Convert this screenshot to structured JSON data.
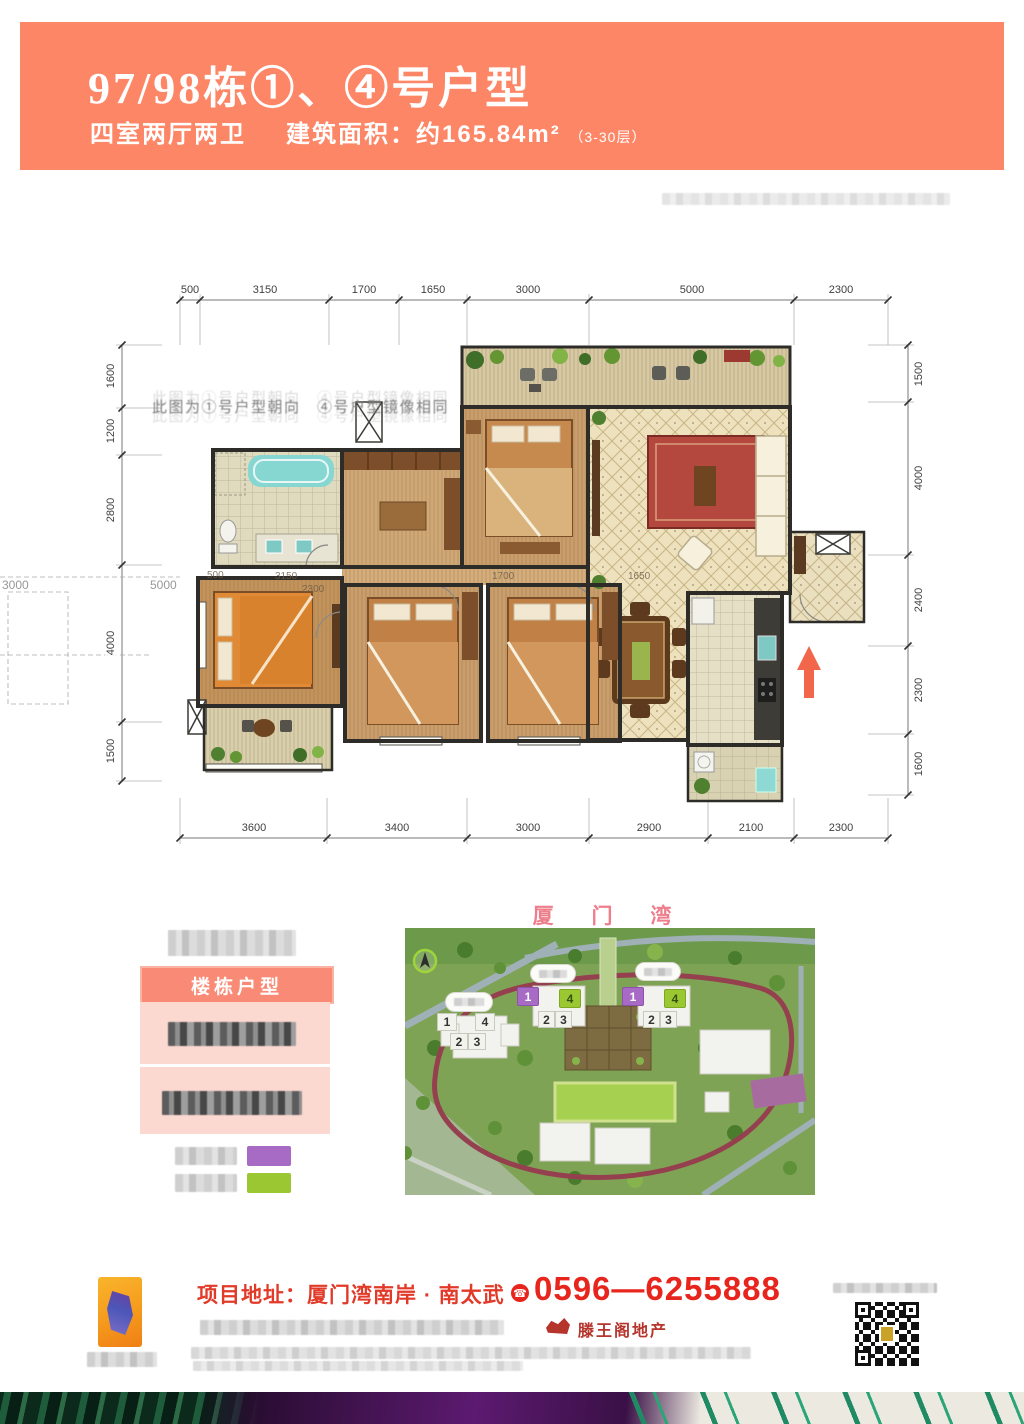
{
  "header": {
    "title": "97/98栋①、④号户型",
    "rooms": "四室两厅两卫",
    "area_label": "建筑面积：",
    "area_value": "约165.84m²",
    "floors": "（3-30层）",
    "bg_color": "#fd8667"
  },
  "plan": {
    "note": "此图为①号户型朝向　④号户型镜像相同",
    "dims_top": [
      "500",
      "3150",
      "1700",
      "1650",
      "3000",
      "5000",
      "2300"
    ],
    "dims_bottom": [
      "3600",
      "3400",
      "3000",
      "2900",
      "2100",
      "2300"
    ],
    "dims_left": [
      "1600",
      "1200",
      "2800",
      "4000",
      "1500"
    ],
    "dims_right": [
      "1500",
      "4000",
      "2400",
      "2300",
      "1600"
    ],
    "ghost_left": [
      "3000",
      "5000"
    ],
    "ghost_inner": [
      "500",
      "3150",
      "2300",
      "1700",
      "1650"
    ]
  },
  "legend": {
    "header": "楼栋户型",
    "purple": "#a76bc6",
    "green": "#9bc832"
  },
  "sitemap": {
    "title": "厦 门 湾",
    "unit_1": "1",
    "unit_2": "2",
    "unit_3": "3",
    "unit_4": "4"
  },
  "footer": {
    "address_label": "项目地址：",
    "address": "厦门湾南岸 · 南太武",
    "phone": "0596—6255888",
    "brand": "滕王阁地产"
  }
}
